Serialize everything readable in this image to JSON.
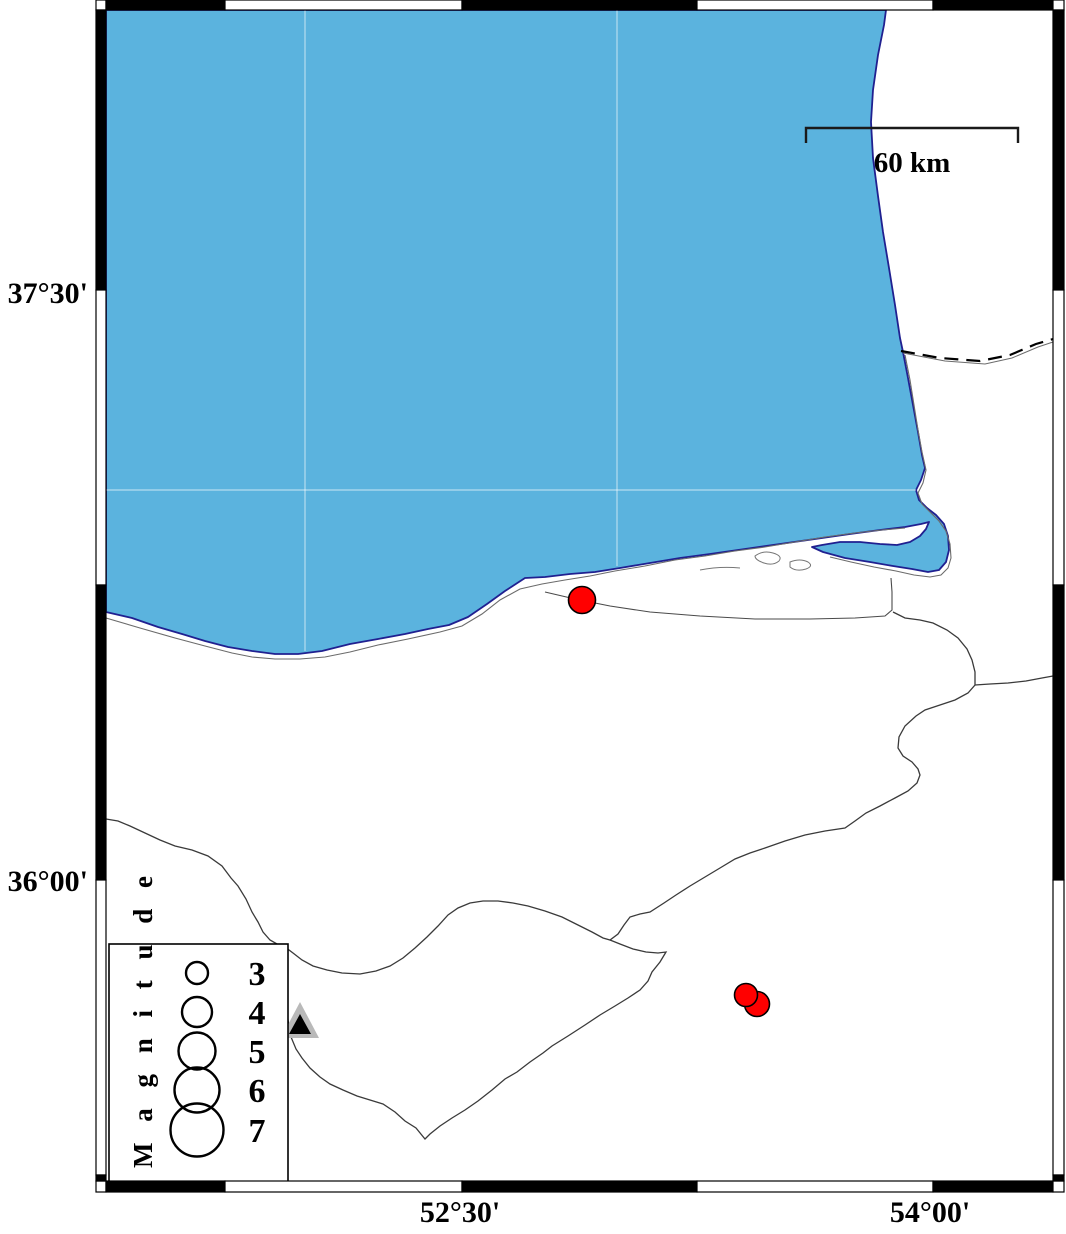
{
  "map": {
    "axis_labels": {
      "lat_top": "37°30'",
      "lat_bottom": "36°00'",
      "lon_left": "52°30'",
      "lon_right": "54°00'"
    },
    "scale_bar": {
      "label": "60 km"
    },
    "legend": {
      "title": "M a g n i t u d e",
      "entries": [
        {
          "magnitude": "3",
          "radius": 11
        },
        {
          "magnitude": "4",
          "radius": 15
        },
        {
          "magnitude": "5",
          "radius": 18.5
        },
        {
          "magnitude": "6",
          "radius": 22.5
        },
        {
          "magnitude": "7",
          "radius": 26.5
        }
      ]
    },
    "earthquakes": [
      {
        "x": 582,
        "y": 600,
        "radius": 13.5
      },
      {
        "x": 757,
        "y": 1004,
        "radius": 12.5
      },
      {
        "x": 746,
        "y": 995,
        "radius": 11.5
      }
    ],
    "station": {
      "x": 300,
      "y": 1022
    },
    "colors": {
      "sea": "#5BB3DE",
      "coast_outline": "#202090",
      "event_fill": "#FF0000",
      "event_stroke": "#000000",
      "station_gray": "#B9B9B9",
      "station_black": "#000000",
      "land": "#FFFFFF",
      "boundary_line": "#3A3A3A",
      "minor_line": "#6B6B6B"
    }
  }
}
